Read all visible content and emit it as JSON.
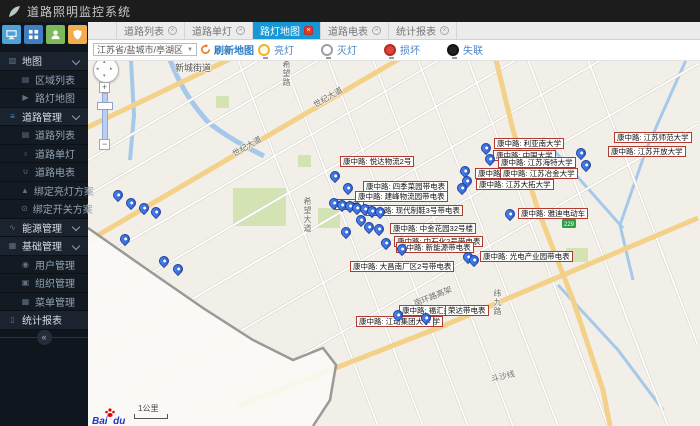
{
  "app": {
    "title": "道路照明监控系统"
  },
  "theme": {
    "titlebar": "#1c1c1c",
    "sidebar_bg": "#10161d",
    "section_bg": "#1b242e",
    "item_bg": "#131a22",
    "active_tab_blue": "#1798d5",
    "tab_close_red": "#dd3b30",
    "link_blue": "#2e7cc3",
    "label_border_red": "#b03a2e",
    "marker_blue": "#2f62d8",
    "map_bg": "#f2efe9",
    "road_yellow": "#f3d189",
    "water_blue": "#a6c9ea",
    "green_area": "#d3e3b3",
    "quick_buttons": [
      "#4da3d8",
      "#3f7fc1",
      "#7db85a",
      "#f0ad4e"
    ]
  },
  "sidebar": {
    "menu": [
      {
        "label": "地图",
        "type": "section",
        "icon": "map-icon",
        "glyph": "▧",
        "chevron": true
      },
      {
        "label": "区域列表",
        "type": "item",
        "icon": "region-list-icon",
        "glyph": "▤"
      },
      {
        "label": "路灯地图",
        "type": "item",
        "icon": "streetlamp-map-icon",
        "glyph": "▶"
      },
      {
        "label": "道路管理",
        "type": "section",
        "icon": "road-management-icon",
        "glyph": "≡",
        "icon_color": "#3b9ad8",
        "chevron": true
      },
      {
        "label": "道路列表",
        "type": "item",
        "icon": "road-list-icon",
        "glyph": "▤"
      },
      {
        "label": "道路单灯",
        "type": "item",
        "icon": "road-lamp-icon",
        "glyph": "♁"
      },
      {
        "label": "道路电表",
        "type": "item",
        "icon": "road-meter-icon",
        "glyph": "∪"
      },
      {
        "label": "绑定亮灯方案",
        "type": "item",
        "icon": "lighting-plan-icon",
        "glyph": "▲"
      },
      {
        "label": "绑定开关方案",
        "type": "item",
        "icon": "switch-plan-icon",
        "glyph": "⊙"
      },
      {
        "label": "能源管理",
        "type": "section",
        "icon": "energy-management-icon",
        "glyph": "∿",
        "chevron": true
      },
      {
        "label": "基础管理",
        "type": "section",
        "icon": "basic-management-icon",
        "glyph": "▦",
        "chevron": true
      },
      {
        "label": "用户管理",
        "type": "item",
        "icon": "user-management-icon",
        "glyph": "◉"
      },
      {
        "label": "组织管理",
        "type": "item",
        "icon": "organization-management-icon",
        "glyph": "▣"
      },
      {
        "label": "菜单管理",
        "type": "item",
        "icon": "menu-management-icon",
        "glyph": "▦"
      },
      {
        "label": "统计报表",
        "type": "section",
        "icon": "statistics-report-icon",
        "glyph": "▯",
        "chevron": false
      }
    ],
    "collapse_glyph": "«"
  },
  "tabs": [
    {
      "label": "道路列表",
      "active": false
    },
    {
      "label": "道路单灯",
      "active": false
    },
    {
      "label": "路灯地图",
      "active": true
    },
    {
      "label": "道路电表",
      "active": false
    },
    {
      "label": "统计报表",
      "active": false
    }
  ],
  "toolbar": {
    "region_select": "江苏省/盐城市/亭湖区",
    "refresh_label": "刷新地图",
    "legend": [
      {
        "label": "亮灯",
        "stroke": "#f0b429",
        "fill": "#fffbe6"
      },
      {
        "label": "灭灯",
        "stroke": "#9aa0a6",
        "fill": "#ffffff"
      },
      {
        "label": "损坏",
        "stroke": "#b52b27",
        "fill": "#d9453e"
      },
      {
        "label": "失联",
        "stroke": "#111111",
        "fill": "#222222"
      }
    ]
  },
  "map": {
    "scale_label": "1公里",
    "attribution": "Baidu",
    "road_shield": "229",
    "road_names": [
      {
        "text": "新城街道",
        "x": 87,
        "y": 1,
        "rot": 0,
        "big": true
      },
      {
        "text": "希望路",
        "x": 193,
        "y": 0,
        "vertical": true
      },
      {
        "text": "世纪大道",
        "x": 224,
        "y": 32,
        "rot": -30
      },
      {
        "text": "世纪大道",
        "x": 143,
        "y": 81,
        "rot": -30
      },
      {
        "text": "希望大道",
        "x": 214,
        "y": 137,
        "vertical": true
      },
      {
        "text": "南环路高架",
        "x": 325,
        "y": 231,
        "rot": -22
      },
      {
        "text": "纬九路",
        "x": 404,
        "y": 229,
        "vertical": true
      },
      {
        "text": "斗沙线",
        "x": 403,
        "y": 311,
        "rot": -14
      }
    ],
    "labels": [
      {
        "x": 252,
        "y": 96,
        "text": "康中路: 悦达物流2号"
      },
      {
        "x": 247,
        "y": 139,
        "text": "康中路"
      },
      {
        "x": 275,
        "y": 121,
        "text": "康中路: 四季菜园带电表"
      },
      {
        "x": 267,
        "y": 131,
        "text": "康中路: 建峰物流园带电表"
      },
      {
        "x": 278,
        "y": 145,
        "text": "康中路: 现代制鞋3号带电表"
      },
      {
        "x": 302,
        "y": 163,
        "text": "康中路: 中金花园32号楼"
      },
      {
        "x": 306,
        "y": 176,
        "text": "康中路: 中石化2号带电表"
      },
      {
        "x": 308,
        "y": 182,
        "text": "康中路: 新能源带电表"
      },
      {
        "x": 262,
        "y": 201,
        "text": "康中路: 大昌南厂区2号带电表"
      },
      {
        "x": 392,
        "y": 191,
        "text": "康中路: 光电产业园带电表"
      },
      {
        "x": 311,
        "y": 245,
        "text": "康中路: 福汇办公区"
      },
      {
        "x": 357,
        "y": 245,
        "text": "荣达带电表"
      },
      {
        "x": 334,
        "y": 256,
        "text": "大学"
      },
      {
        "x": 268,
        "y": 256,
        "text": "康中路: 江动集团大学"
      },
      {
        "x": 406,
        "y": 78,
        "text": "康中路: 利亚南大学"
      },
      {
        "x": 405,
        "y": 90,
        "text": "康中路: 中国大学"
      },
      {
        "x": 410,
        "y": 97,
        "text": "康中路: 江苏海特大学"
      },
      {
        "x": 387,
        "y": 108,
        "text": "康中路"
      },
      {
        "x": 412,
        "y": 108,
        "text": "康中路: 江苏冶金大学"
      },
      {
        "x": 388,
        "y": 119,
        "text": "康中路: 江苏大拓大学"
      },
      {
        "x": 430,
        "y": 148,
        "text": "康中路: 雅迪电动车"
      },
      {
        "x": 526,
        "y": 72,
        "text": "康中路: 江苏师范大学"
      },
      {
        "x": 520,
        "y": 86,
        "text": "康中路: 江苏开放大学"
      }
    ],
    "markers": [
      {
        "x": 30,
        "y": 136
      },
      {
        "x": 43,
        "y": 144
      },
      {
        "x": 56,
        "y": 149
      },
      {
        "x": 68,
        "y": 153
      },
      {
        "x": 37,
        "y": 180
      },
      {
        "x": 76,
        "y": 202
      },
      {
        "x": 90,
        "y": 210
      },
      {
        "x": 247,
        "y": 117
      },
      {
        "x": 260,
        "y": 129
      },
      {
        "x": 246,
        "y": 144
      },
      {
        "x": 254,
        "y": 146
      },
      {
        "x": 262,
        "y": 147
      },
      {
        "x": 269,
        "y": 149
      },
      {
        "x": 277,
        "y": 150
      },
      {
        "x": 284,
        "y": 152
      },
      {
        "x": 292,
        "y": 153
      },
      {
        "x": 273,
        "y": 161
      },
      {
        "x": 281,
        "y": 168
      },
      {
        "x": 291,
        "y": 170
      },
      {
        "x": 258,
        "y": 173
      },
      {
        "x": 298,
        "y": 184
      },
      {
        "x": 314,
        "y": 190
      },
      {
        "x": 380,
        "y": 198
      },
      {
        "x": 386,
        "y": 201
      },
      {
        "x": 310,
        "y": 256
      },
      {
        "x": 338,
        "y": 259
      },
      {
        "x": 398,
        "y": 89
      },
      {
        "x": 402,
        "y": 100
      },
      {
        "x": 377,
        "y": 112
      },
      {
        "x": 379,
        "y": 122
      },
      {
        "x": 374,
        "y": 129
      },
      {
        "x": 422,
        "y": 155
      },
      {
        "x": 493,
        "y": 94
      },
      {
        "x": 498,
        "y": 106
      }
    ]
  }
}
